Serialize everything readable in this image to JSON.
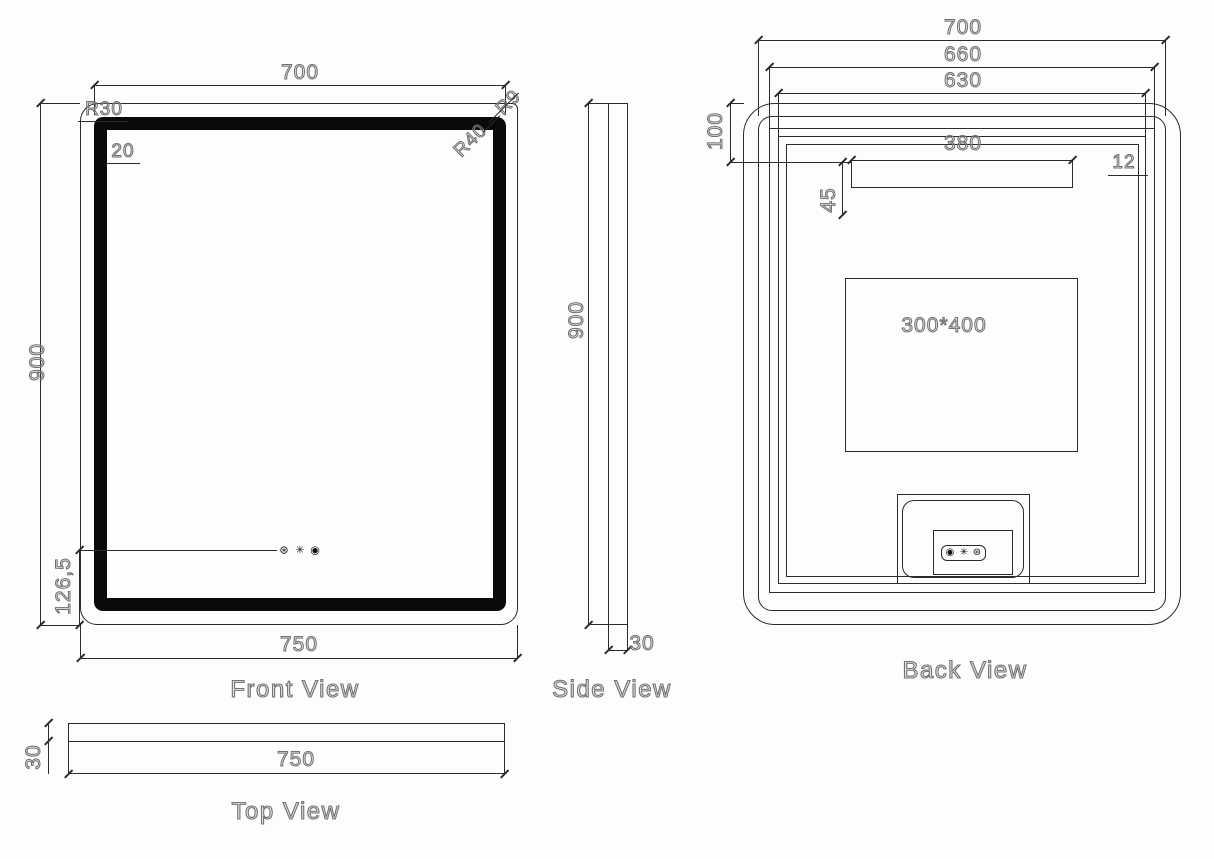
{
  "front_view": {
    "label": "Front View",
    "dim_top_width": "700",
    "dim_height": "900",
    "dim_bottom_width": "750",
    "dim_button_offset": "126,5",
    "dim_border_width": "20",
    "radius_outer": "R30",
    "radius_top_right": "R9",
    "radius_inner": "R40",
    "icons": {
      "light": "⊛",
      "defog": "✳",
      "power": "◉"
    }
  },
  "side_view": {
    "label": "Side View",
    "dim_height": "900",
    "dim_thickness": "30"
  },
  "top_view": {
    "label": "Top View",
    "dim_width": "750",
    "dim_thickness": "30"
  },
  "back_view": {
    "label": "Back View",
    "dim_width_outer": "700",
    "dim_width_mid": "660",
    "dim_width_inner": "630",
    "dim_top_offset": "100",
    "dim_bracket_width": "380",
    "dim_edge_gap": "12",
    "dim_bracket_offset": "45",
    "demister_size": "300*400",
    "icons": {
      "power": "◉",
      "defog": "✳",
      "light": "⊛"
    }
  },
  "colors": {
    "line": "#2b2b2b",
    "frame": "#0a0a0a",
    "dim_text_stroke": "#6f6f6f",
    "background": "#fdfdfd"
  }
}
